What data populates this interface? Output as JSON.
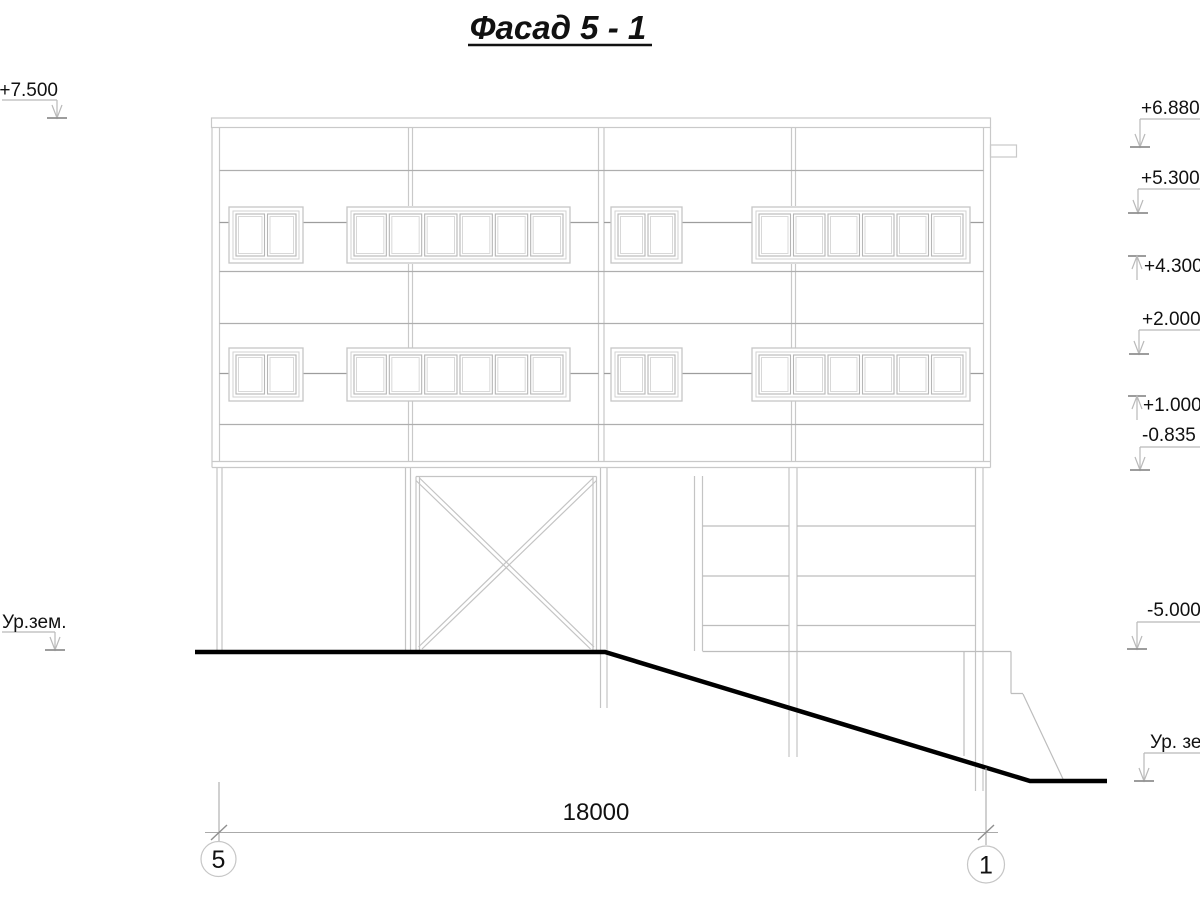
{
  "title": "Фасад 5 - 1",
  "dimension_label": "18000",
  "axis_bubbles": {
    "left": "5",
    "right": "1"
  },
  "elevation_marks_left": [
    {
      "label": "+7.500"
    },
    {
      "label": "Ур.зем."
    }
  ],
  "elevation_marks_right": [
    {
      "label": "+6.880"
    },
    {
      "label": "+5.300"
    },
    {
      "label": "+4.300"
    },
    {
      "label": "+2.000"
    },
    {
      "label": "+1.000"
    },
    {
      "label": "-0.835"
    },
    {
      "label": "-5.000"
    },
    {
      "label": "Ур. зе"
    }
  ]
}
